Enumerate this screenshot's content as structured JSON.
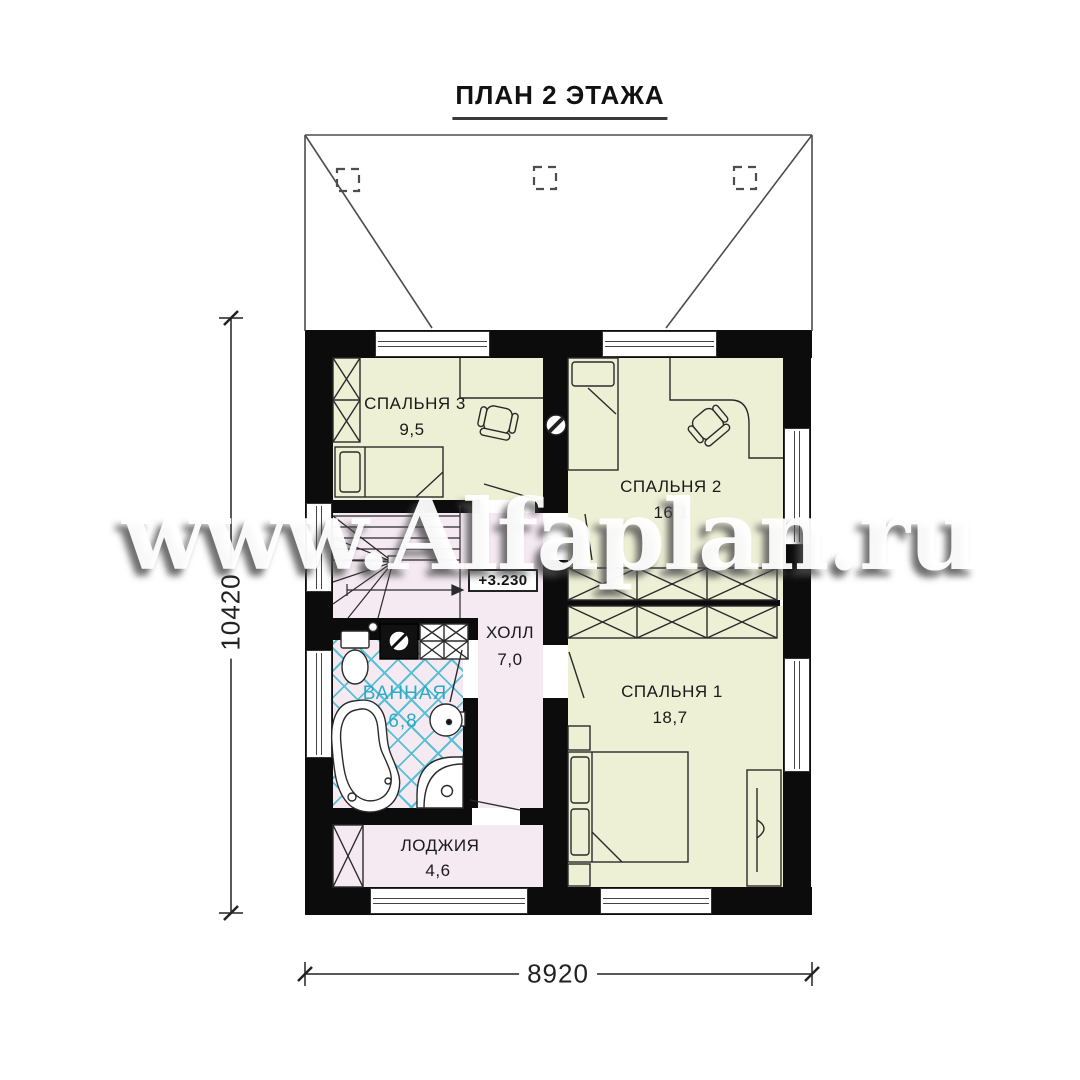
{
  "title": "ПЛАН 2 ЭТАЖА",
  "watermark": "www.Alfaplan.ru",
  "rooms": {
    "bedroom3": {
      "label": "СПАЛЬНЯ 3",
      "area": "9,5"
    },
    "bedroom2": {
      "label": "СПАЛЬНЯ 2",
      "area": "16,1"
    },
    "bedroom1": {
      "label": "СПАЛЬНЯ 1",
      "area": "18,7"
    },
    "hall": {
      "label": "ХОЛЛ",
      "area": "7,0"
    },
    "bathroom": {
      "label": "ВАННАЯ",
      "area": "6,8"
    },
    "loggia": {
      "label": "ЛОДЖИЯ",
      "area": "4,6"
    }
  },
  "elevation_mark": "+3.230",
  "dimensions": {
    "vertical": "10420",
    "horizontal": "8920"
  },
  "colors": {
    "room_fill": "#eef0d6",
    "service_fill": "#f5e9f2",
    "tile_line": "#3db8cf",
    "wall": "#0c0c0c",
    "bathroom_text": "#29abc6",
    "label_text": "#1a1a1a"
  }
}
